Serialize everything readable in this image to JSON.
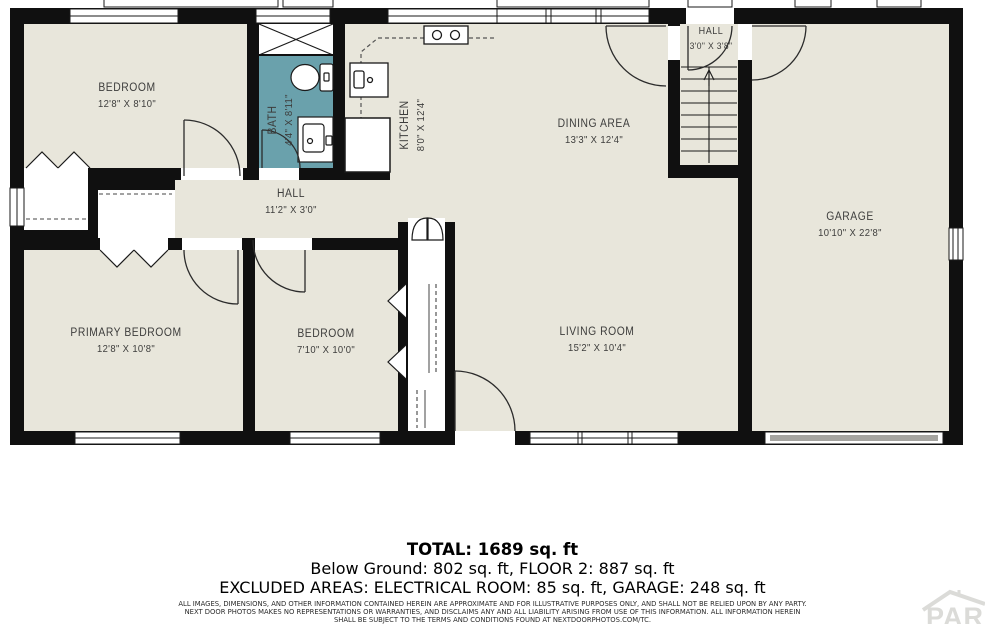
{
  "plan": {
    "rooms": [
      {
        "id": "bedroom-top",
        "name": "BEDROOM",
        "dims": "12'8\" X 8'10\""
      },
      {
        "id": "bath",
        "name": "BATH",
        "dims": "4'4\" X 8'11\""
      },
      {
        "id": "kitchen",
        "name": "KITCHEN",
        "dims": "8'0\" X 12'4\""
      },
      {
        "id": "dining-area",
        "name": "DINING AREA",
        "dims": "13'3\" X 12'4\""
      },
      {
        "id": "hall-upper",
        "name": "HALL",
        "dims": "3'0\" X 3'8\""
      },
      {
        "id": "garage",
        "name": "GARAGE",
        "dims": "10'10\" X 22'8\""
      },
      {
        "id": "hall-main",
        "name": "HALL",
        "dims": "11'2\" X 3'0\""
      },
      {
        "id": "primary-bedroom",
        "name": "PRIMARY BEDROOM",
        "dims": "12'8\" X 10'8\""
      },
      {
        "id": "bedroom-lower",
        "name": "BEDROOM",
        "dims": "7'10\" X 10'0\""
      },
      {
        "id": "living-room",
        "name": "LIVING ROOM",
        "dims": "15'2\" X 10'4\""
      }
    ],
    "colors": {
      "floor": "#e8e6db",
      "wall": "#101010",
      "bath_floor": "#6aa1ac",
      "garage_door": "#a5a4a0",
      "watermark": "#dbdbd8"
    }
  },
  "summary": {
    "total": "TOTAL: 1689 sq. ft",
    "line2": "Below Ground: 802 sq. ft, FLOOR 2: 887 sq. ft",
    "line3": "EXCLUDED AREAS: ELECTRICAL ROOM: 85 sq. ft, GARAGE: 248 sq. ft",
    "disclaimer1": "ALL IMAGES, DIMENSIONS, AND OTHER INFORMATION CONTAINED HEREIN ARE APPROXIMATE AND FOR ILLUSTRATIVE PURPOSES ONLY, AND SHALL NOT BE RELIED UPON BY ANY PARTY.",
    "disclaimer2": "NEXT DOOR PHOTOS MAKES NO REPRESENTATIONS OR WARRANTIES, AND DISCLAIMS ANY AND ALL LIABILITY ARISING FROM USE OF THIS INFORMATION. ALL INFORMATION HEREIN",
    "disclaimer3": "SHALL BE SUBJECT TO THE TERMS AND CONDITIONS FOUND AT NEXTDOORPHOTOS.COM/TC."
  },
  "branding": {
    "watermark": "PAR"
  }
}
